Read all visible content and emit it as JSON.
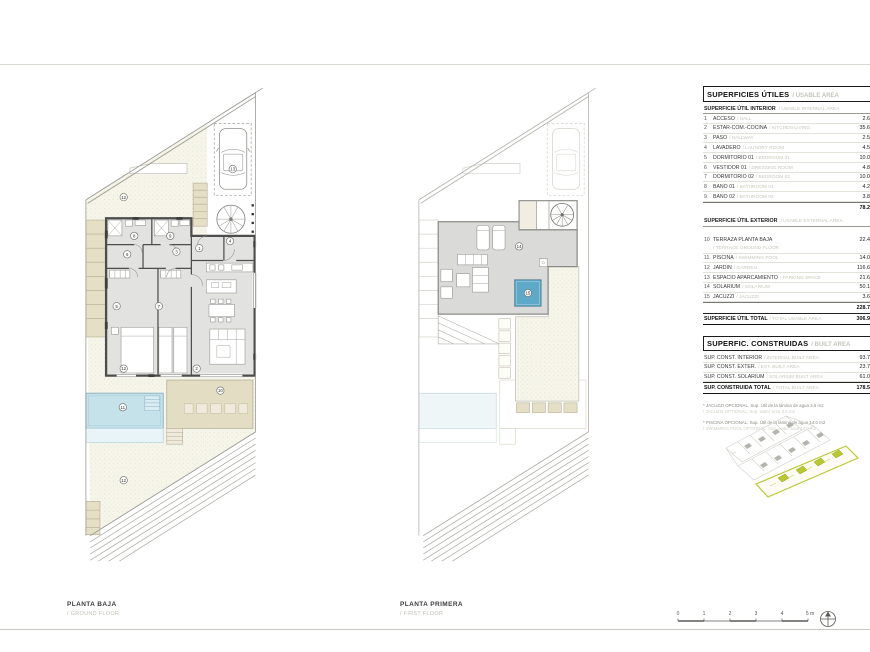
{
  "colors": {
    "pool": "#c5e2ea",
    "pool_edge": "#8fb4c0",
    "jacuzzi": "#5ea9c8",
    "terrace": "#e3ddc4",
    "keymap_green": "#b9c832"
  },
  "plans": [
    {
      "title": "PLANTA BAJA",
      "subtitle": "/ GROUND FLOOR",
      "labels": [
        "8",
        "9",
        "6",
        "3",
        "1",
        "4",
        "5",
        "7",
        "2",
        "13",
        "12",
        "12",
        "11",
        "10",
        "12"
      ]
    },
    {
      "title": "PLANTA PRIMERA",
      "subtitle": "/ FIRST FLOOR",
      "labels": [
        "14",
        "15"
      ]
    }
  ],
  "scalebar": {
    "ticks": [
      "0",
      "1",
      "2",
      "3",
      "4",
      "5 m"
    ]
  },
  "area_table": {
    "title_es": "SUPERFICIES ÚTILES",
    "title_en": "/ USABLE AREA",
    "int_head_es": "SUPERFICIE ÚTIL INTERIOR",
    "int_head_en": "/ USABLE INTERNAL AREA",
    "int_rows": [
      {
        "n": "1",
        "es": "ACCESO",
        "en": "/ HALL",
        "val": "2.60"
      },
      {
        "n": "2",
        "es": "ESTAR-COM.-COCINA",
        "en": "/ KITCHEN-LIVING",
        "val": "35.60"
      },
      {
        "n": "3",
        "es": "PASO",
        "en": "/ HALLWAY",
        "val": "2.50"
      },
      {
        "n": "4",
        "es": "LAVADERO",
        "en": "/ LAUNDRY ROOM",
        "val": "4.50"
      },
      {
        "n": "5",
        "es": "DORMITORIO 01",
        "en": "/ BEDROOM 01",
        "val": "10.00"
      },
      {
        "n": "6",
        "es": "VESTIDOR 01",
        "en": "/ DRESSING ROOM",
        "val": "4.80"
      },
      {
        "n": "7",
        "es": "DORMITORIO 02",
        "en": "/ BEDROOM 02",
        "val": "10.00"
      },
      {
        "n": "8",
        "es": "BAÑO 01",
        "en": "/ BATHROOM 01",
        "val": "4.20"
      },
      {
        "n": "9",
        "es": "BAÑO 02",
        "en": "/ BATHROOM 02",
        "val": "3.80"
      }
    ],
    "int_total": "78.20",
    "ext_head_es": "SUPERFICIE ÚTIL EXTERIOR",
    "ext_head_en": "/ USABLE EXTERNAL AREA",
    "ext_rows": [
      {
        "n": "10",
        "es": "TERRAZA PLANTA BAJA",
        "en": "/ TERRACE GROUND FLOOR",
        "val": "22.40"
      },
      {
        "n": "11",
        "es": "PISCINA",
        "en": "/ SWIMMING POOL",
        "val": "14.00"
      },
      {
        "n": "12",
        "es": "JARDÍN",
        "en": "/ GARDEN",
        "val": "116.60"
      },
      {
        "n": "13",
        "es": "ESPACIO APARCAMIENTO",
        "en": "/ PARKING SPACE",
        "val": "21.60"
      },
      {
        "n": "14",
        "es": "SOLARIUM",
        "en": "/ SOLARIUM",
        "val": "50.10"
      },
      {
        "n": "15",
        "es": "JACUZZI",
        "en": "/ JACUZZI",
        "val": "3.60"
      }
    ],
    "ext_total": "228.70",
    "grand_es": "SUPERFICIE ÚTIL TOTAL",
    "grand_en": "/ TOTAL USABLE AREA",
    "grand_val": "306.90"
  },
  "built_table": {
    "title_es": "SUPERFIC. CONSTRUIDAS",
    "title_en": "/ BUILT AREA",
    "rows": [
      {
        "es": "SUP. CONST. INTERIOR",
        "en": "/ INTERNAL BUILT AREA",
        "val": "93.70"
      },
      {
        "es": "SUP. CONST. EXTER.",
        "en": "/ EXT. BUILT AREA",
        "val": "23.70"
      },
      {
        "es": "SUP. CONST. SOLARIUM",
        "en": "/ SOLARIUM BUILT AREA",
        "val": "61.00"
      }
    ],
    "total_es": "SUP. CONSTRUIDA TOTAL",
    "total_en": "/ TOTAL BUILT AREA",
    "total_val": "178.50"
  },
  "footnotes": [
    {
      "es": "* JACUZZI OPCIONAL. Sup. Útil de la lámina de agua 3.6 m2",
      "en": "/ JACUZZI OPTIONAL. Sup. water area 3.6 m2"
    },
    {
      "es": "* PISCINA OPCIONAL. Sup. Útil de la lámina de agua 14.0 m2",
      "en": "/ SWIMMING POOL OPTIONAL. Sup. water area 14.0 m2"
    }
  ]
}
